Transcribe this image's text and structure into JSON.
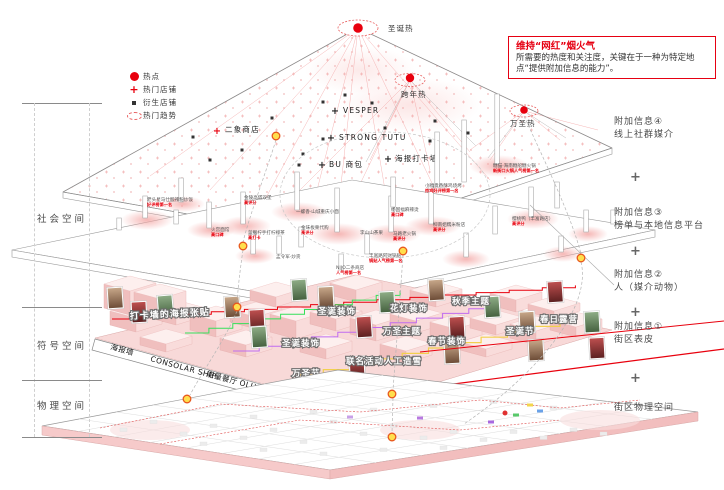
{
  "legend": {
    "items": [
      {
        "icon": "hotspot-dot-icon",
        "label": "热点"
      },
      {
        "icon": "hot-shop-plus-icon",
        "label": "热门店铺"
      },
      {
        "icon": "derived-shop-square-icon",
        "label": "衍生店铺"
      },
      {
        "icon": "hot-trend-ellipse-icon",
        "label": "热门趋势"
      }
    ]
  },
  "info_box": {
    "title": "维持“网红”烟火气",
    "body": "所需要的热度和关注度，关键在于一种为特定地点“提供附加信息的能力”。"
  },
  "left_axis": {
    "labels": [
      "社会空间",
      "符号空间",
      "物理空间"
    ]
  },
  "right_column": {
    "plus": "+",
    "items": [
      {
        "no": "附加信息④",
        "name": "线上社群媒介"
      },
      {
        "no": "附加信息③",
        "name": "榜单与本地信息平台"
      },
      {
        "no": "附加信息②",
        "name": "人（媒介动物）"
      },
      {
        "no": "附加信息①",
        "name": "街区表皮"
      }
    ],
    "base": "街区物理空间"
  },
  "heat_layer": {
    "peaks": [
      "圣诞热",
      "跨年热",
      "万圣热"
    ],
    "shops": [
      "VESPER",
      "STRONG TUTU",
      "海报打卡墙",
      "BU 商包",
      "二象商店"
    ]
  },
  "ranking_layer": {
    "shops": [
      {
        "name": "老头星马仕酸辣粉炒饭",
        "note": "好评榜第一名"
      },
      {
        "name": "金陵高塔双堡",
        "note": "高评分"
      },
      {
        "name": "火宫面馆",
        "note": "高口碑"
      },
      {
        "name": "蓝胭柠手打柠檬茶",
        "note": "高打卡"
      },
      {
        "name": "一螺香·山城重庆小面",
        "note": ""
      },
      {
        "name": "金味板栗代购",
        "note": "高评分"
      },
      {
        "name": "孟令军·炒货",
        "note": ""
      },
      {
        "name": "NIJO二条商店",
        "note": "人气榜第一名"
      },
      {
        "name": "丰富路阿财锅贴",
        "note": "锅贴人气榜第一名"
      },
      {
        "name": "李山山茶果",
        "note": ""
      },
      {
        "name": "马路老火锅",
        "note": "高评分"
      },
      {
        "name": "杨国福麻辣烫",
        "note": "高口碑"
      },
      {
        "name": "小福贵香酥鸡烧烤",
        "note": "炸鸡好评榜第一名"
      },
      {
        "name": "柳南姐糯米粉店",
        "note": "高评分"
      },
      {
        "name": "樱桃鸭（丰富路店）",
        "note": "高评分"
      },
      {
        "name": "糖猫·海南糖船糖火锅",
        "note": "新街口火锅人气榜第一名"
      }
    ]
  },
  "symbol_layer": {
    "wall_note": "打卡墙的海报张贴",
    "themes": [
      "圣诞装饰",
      "圣诞装饰",
      "花灯装饰",
      "秋季主题",
      "万圣主题",
      "春节装饰",
      "圣诞节",
      "春日露营",
      "联名活动人工造雪",
      "万圣节"
    ],
    "band": [
      "海报墙",
      "CONSOLAR SHIP",
      "能量餐厅",
      "OLLY OWL",
      "STRONG TUTU"
    ]
  },
  "colors": {
    "accent_red": "#e60012",
    "hot_red": "#e8000d",
    "marker_ring": "#e8571d",
    "marker_fill": "#ffdf4d",
    "pink_block": "#f8d9d8"
  }
}
